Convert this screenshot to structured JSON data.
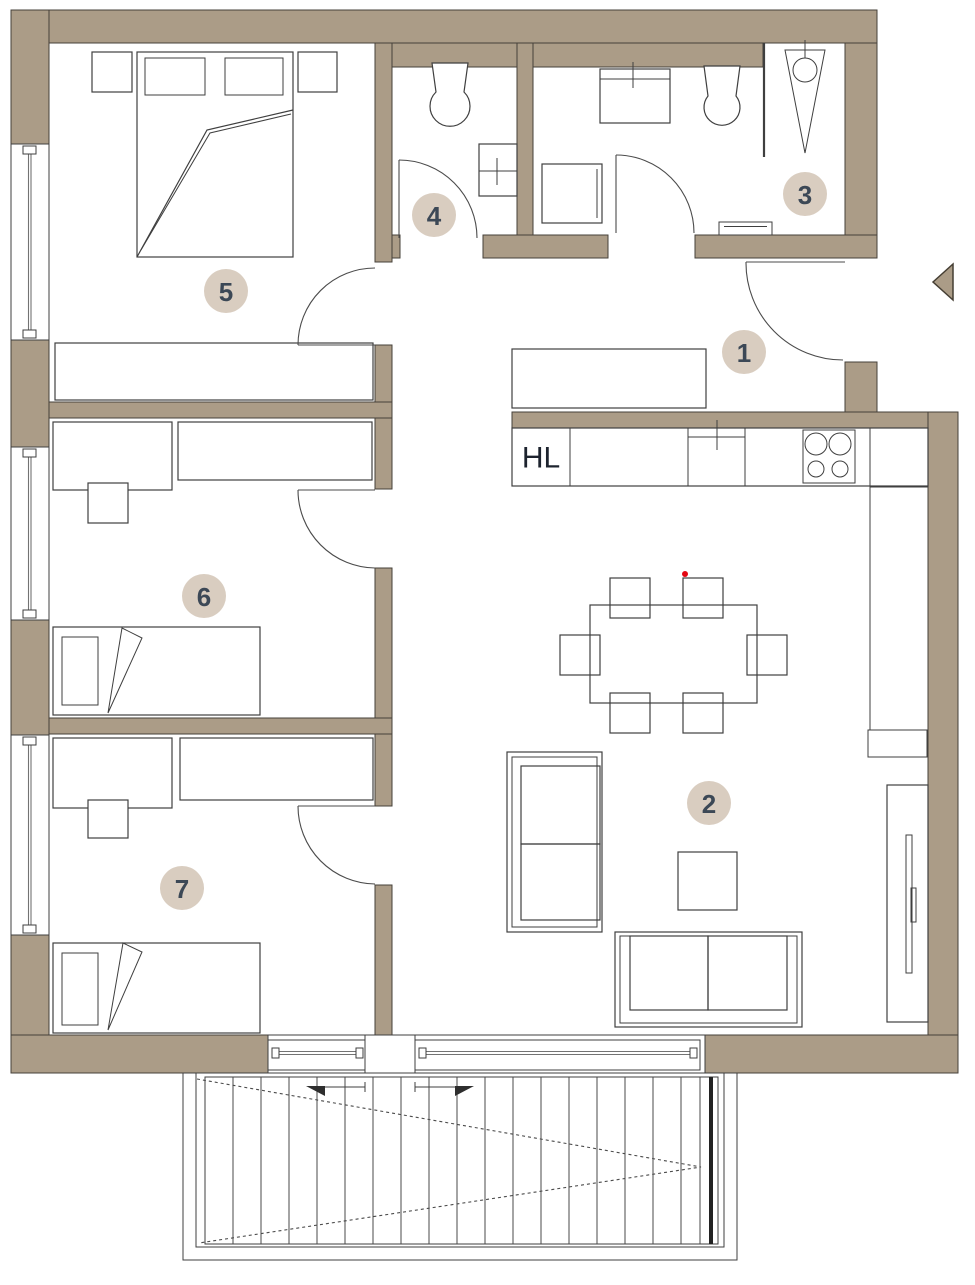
{
  "plan": {
    "rooms": [
      {
        "number": "1"
      },
      {
        "number": "2"
      },
      {
        "number": "3"
      },
      {
        "number": "4"
      },
      {
        "number": "5"
      },
      {
        "number": "6"
      },
      {
        "number": "7"
      }
    ],
    "kitchen": {
      "shaft_label": "HL"
    },
    "colors": {
      "bg": "#ffffff",
      "wall": "#ab9c87",
      "wallline": "#46403a",
      "line": "#3f3f3f",
      "glass": "#737373",
      "circle": "#d9cdc0",
      "number": "#3c4856",
      "hltext": "#1d232e",
      "arc": "#4b4b4b",
      "reddot": "#e30613"
    }
  }
}
